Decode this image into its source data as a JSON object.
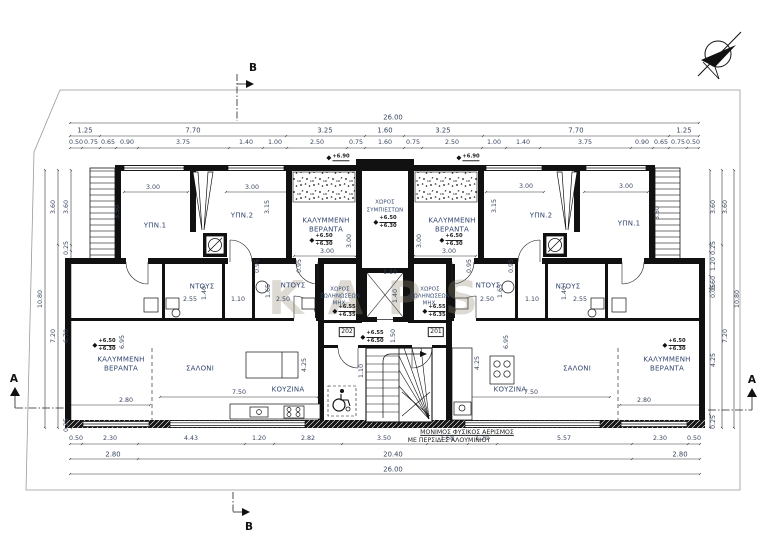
{
  "drawing": {
    "watermark": "KAPS",
    "north_arrow_icon": "north-arrow-compass",
    "section_markers": {
      "top": "B",
      "bottom": "B",
      "left": "A",
      "right": "A"
    },
    "door_tags": {
      "left": "202",
      "right": "201"
    },
    "notes": {
      "vent_line1": "ΜΟΝΙΜΟΣ ΦΥΣΙΚΟΣ ΑΕΡΙΣΜΟΣ",
      "vent_line2": "ΜΕ ΠΕΡΣΙΔΕΣ ΑΛΟΥΜΙΝΙΟΥ"
    },
    "levels": {
      "top_slab": "+6.90",
      "veranda_hi": "+6.50",
      "veranda_lo": "+6.30",
      "mech_hi": "+6.55",
      "mech_lo": "+6.35",
      "hall_hi": "+6.55",
      "hall_lo": "+6.50"
    }
  },
  "rooms": {
    "bedroom1": "ΥΠΝ.1",
    "bedroom2": "ΥΠΝ.2",
    "veranda_l1": "ΚΑΛΥΜΜΕΝΗ",
    "veranda_l2": "ΒΕΡΑΝΤΑ",
    "compressor_l1": "ΧΩΡΟΣ",
    "compressor_l2": "ΣΥΜΠΙΕΣΤΩΝ",
    "mech_l1": "ΧΩΡΟΣ",
    "mech_l2": "ΣΩΛΗΝΩΣΕΩΝ",
    "mech_l3": "ΜΗΧ.",
    "shower": "ΝΤΟΥΣ",
    "living": "ΣΑΛΟΝΙ",
    "kitchen": "ΚΟΥΖΙΝΑ"
  },
  "dims": {
    "top_total": "26.00",
    "top_major": [
      "1.25",
      "7.70",
      "3.25",
      "1.60",
      "3.25",
      "7.70",
      "1.25"
    ],
    "top_minor": [
      "0.50",
      "0.75",
      "0.65",
      "0.90",
      "3.75",
      "1.40",
      "1.00",
      "2.50",
      "0.75",
      "1.60",
      "0.75",
      "2.50",
      "1.00",
      "1.40",
      "3.75",
      "0.90",
      "0.65",
      "0.75",
      "0.50"
    ],
    "bottom_minor": [
      "0.50",
      "2.30",
      "4.43",
      "1.20",
      "2.82",
      "3.50",
      "1.68",
      "1.20",
      "5.57",
      "2.30",
      "0.50"
    ],
    "bottom_major": [
      "2.80",
      "20.40",
      "2.80"
    ],
    "bottom_total": "26.00",
    "left_inner": [
      "3.60",
      "0.25",
      "6.70",
      "0.25"
    ],
    "left_mid": [
      "3.60",
      "7.20"
    ],
    "left_total": "10.80",
    "right_inner": [
      "3.60",
      "0.25",
      "1.20",
      "0.60",
      "0.05",
      "4.25",
      "0.25"
    ],
    "right_mid": [
      "3.60",
      "7.20"
    ],
    "right_total": "10.80",
    "bed_w": "3.00",
    "bed_h1": "3.50",
    "bed_h2": "3.15",
    "ver_w": "3.00",
    "ver_h": "3.00",
    "off95": "0.95",
    "sh255": "2.55",
    "sh140": "1.40",
    "sh110": "1.10",
    "sh250": "2.50",
    "sh165": "1.65",
    "salon_w": "7.50",
    "ver_bw": "2.80",
    "k425": "4.25",
    "h695": "6.95",
    "hall150": "1.50",
    "elev_w": "1.10",
    "elev_d": "1.40",
    "stair110": "1.10"
  }
}
